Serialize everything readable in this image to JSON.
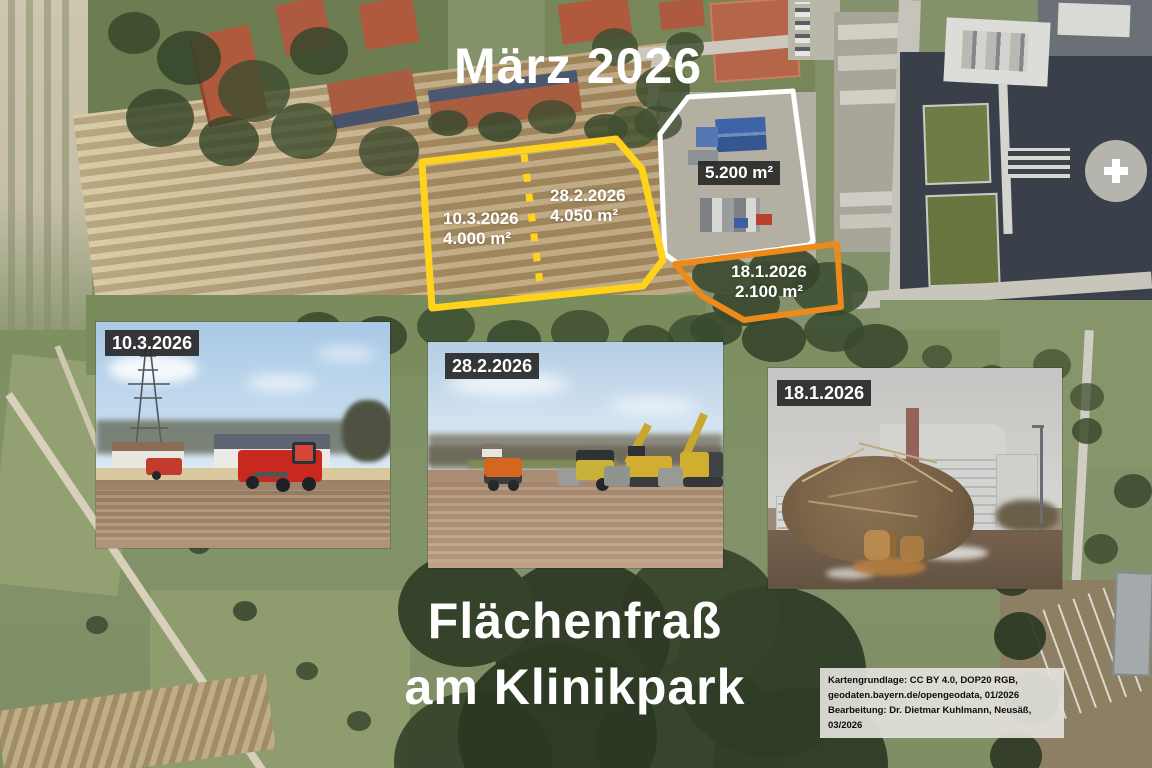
{
  "map": {
    "month_title": "März 2026",
    "annotations": {
      "plot_a": {
        "date": "10.3.2026",
        "area": "4.000 m²"
      },
      "plot_b": {
        "date": "28.2.2026",
        "area": "4.050 m²"
      },
      "plot_c": {
        "area": "5.200 m²"
      },
      "plot_d": {
        "date": "18.1.2026",
        "area": "2.100 m²"
      }
    }
  },
  "photos": [
    {
      "label": "10.3.2026"
    },
    {
      "label": "28.2.2026"
    },
    {
      "label": "18.1.2026"
    }
  ],
  "caption": {
    "line1": "Flächenfraß",
    "line2": "am Klinikpark"
  },
  "credits": {
    "line1": "Kartengrundlage: CC BY 4.0, DOP20 RGB,",
    "line2": "geodaten.bayern.de/opengeodata, 01/2026",
    "line3": "Bearbeitung: Dr. Dietmar Kuhlmann, Neusäß, 03/2026"
  },
  "colors": {
    "yellow": "#FFD21C",
    "orange": "#EC8A1C",
    "white": "#FFFFFF"
  }
}
